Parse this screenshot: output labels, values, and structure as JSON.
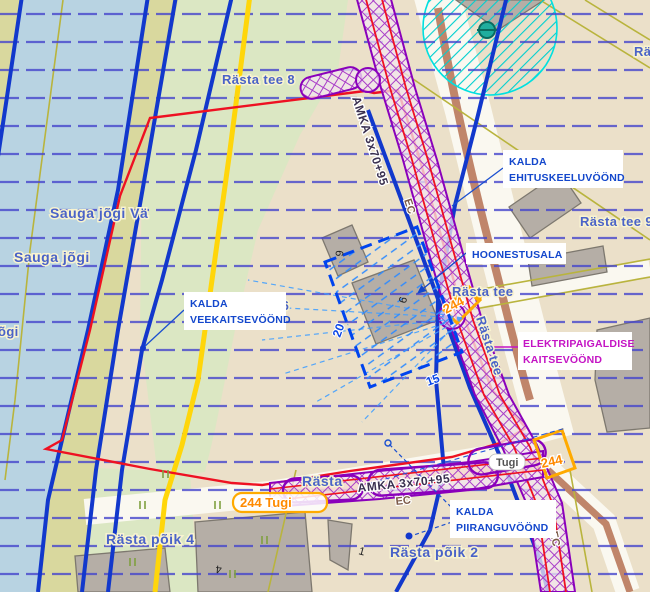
{
  "map": {
    "streets": {
      "rasta_tee_8": "Rästa tee 8",
      "sauga_jogi_va": "Sauga jõgi Vä",
      "sauga_jogi": "Sauga jõgi",
      "jogi_partial": "õgi",
      "rasta_tee_6_partial": "e 6",
      "rasta_tee_9": "Rästa tee 9",
      "rasta_tee_h": "Rästa tee",
      "rasta_tee_v": "Rästa tee",
      "ra_partial": "Rä",
      "rasta_poik_4": "Rästa põik 4",
      "rasta_poik_2": "Rästa põik 2",
      "rasta_partial": "Rästa"
    },
    "callouts": {
      "ehituskeeluvoond": {
        "line1": "KALDA",
        "line2": "EHITUSKEELUVÖÖND"
      },
      "hoonestusala": {
        "line1": "HOONESTUSALA"
      },
      "veekaitsevoond": {
        "line1": "KALDA",
        "line2": "VEEKAITSEVÖÖND"
      },
      "elektripaigaldise": {
        "line1": "ELEKTRIPAIGALDISE",
        "line2": "KAITSEVÖÖND"
      },
      "piiranguvoond": {
        "line1": "KALDA",
        "line2": "PIIRANGUVÖÖND"
      }
    },
    "cables": {
      "amka_top": "AMKA 3x70+95",
      "amka_bottom": "AMKA 3x70+95",
      "ec_top": "EC",
      "ec_bottom": "EC",
      "ec_right": "EC"
    },
    "supports": {
      "s244_mid": "244",
      "s244_tugi_bottom": "244  Tugi",
      "tugi_pill": "Tugi",
      "s244_bottom_right": "244"
    },
    "dimensions": {
      "side_long": "20",
      "side_short": "15"
    },
    "house_numbers": {
      "plot9": "9",
      "plot6": "6",
      "plot4": "4",
      "plot1": "1"
    },
    "colors": {
      "water": "#b8d3e2",
      "boundary_red": "#ee1122",
      "cable_purple": "#9900cc",
      "zone_label_blue": "#1347cc",
      "electrical_label_magenta": "#c414c4",
      "support_orange": "#ff8a00",
      "shore_hatch_blue": "#4545cc",
      "well_zone_cyan": "#00d5d5"
    }
  }
}
